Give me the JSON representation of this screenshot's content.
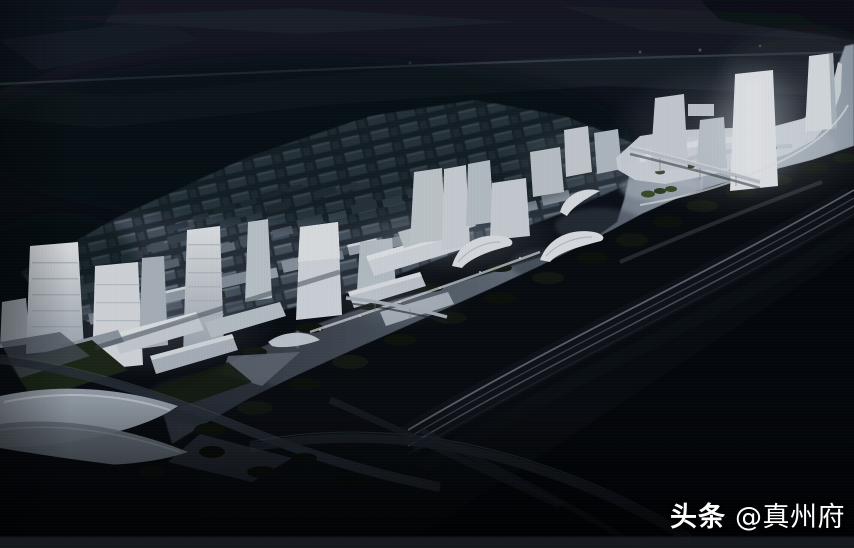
{
  "watermark": {
    "brand": "头条",
    "handle": "@真州府"
  },
  "palette": {
    "background": "#06080c",
    "distant_terrain": "#1d242c",
    "district_block": "#505c6a",
    "building_bright": "#f5f8fb",
    "building_mid": "#c9d1d8",
    "river_light": "#aeb9c5",
    "river_dark": "#2e343d",
    "vegetation": "#0e120b",
    "lawn": "#1d2817",
    "railway": "#141920",
    "road": "#2c333c",
    "watermark_color": "#ffffff"
  }
}
